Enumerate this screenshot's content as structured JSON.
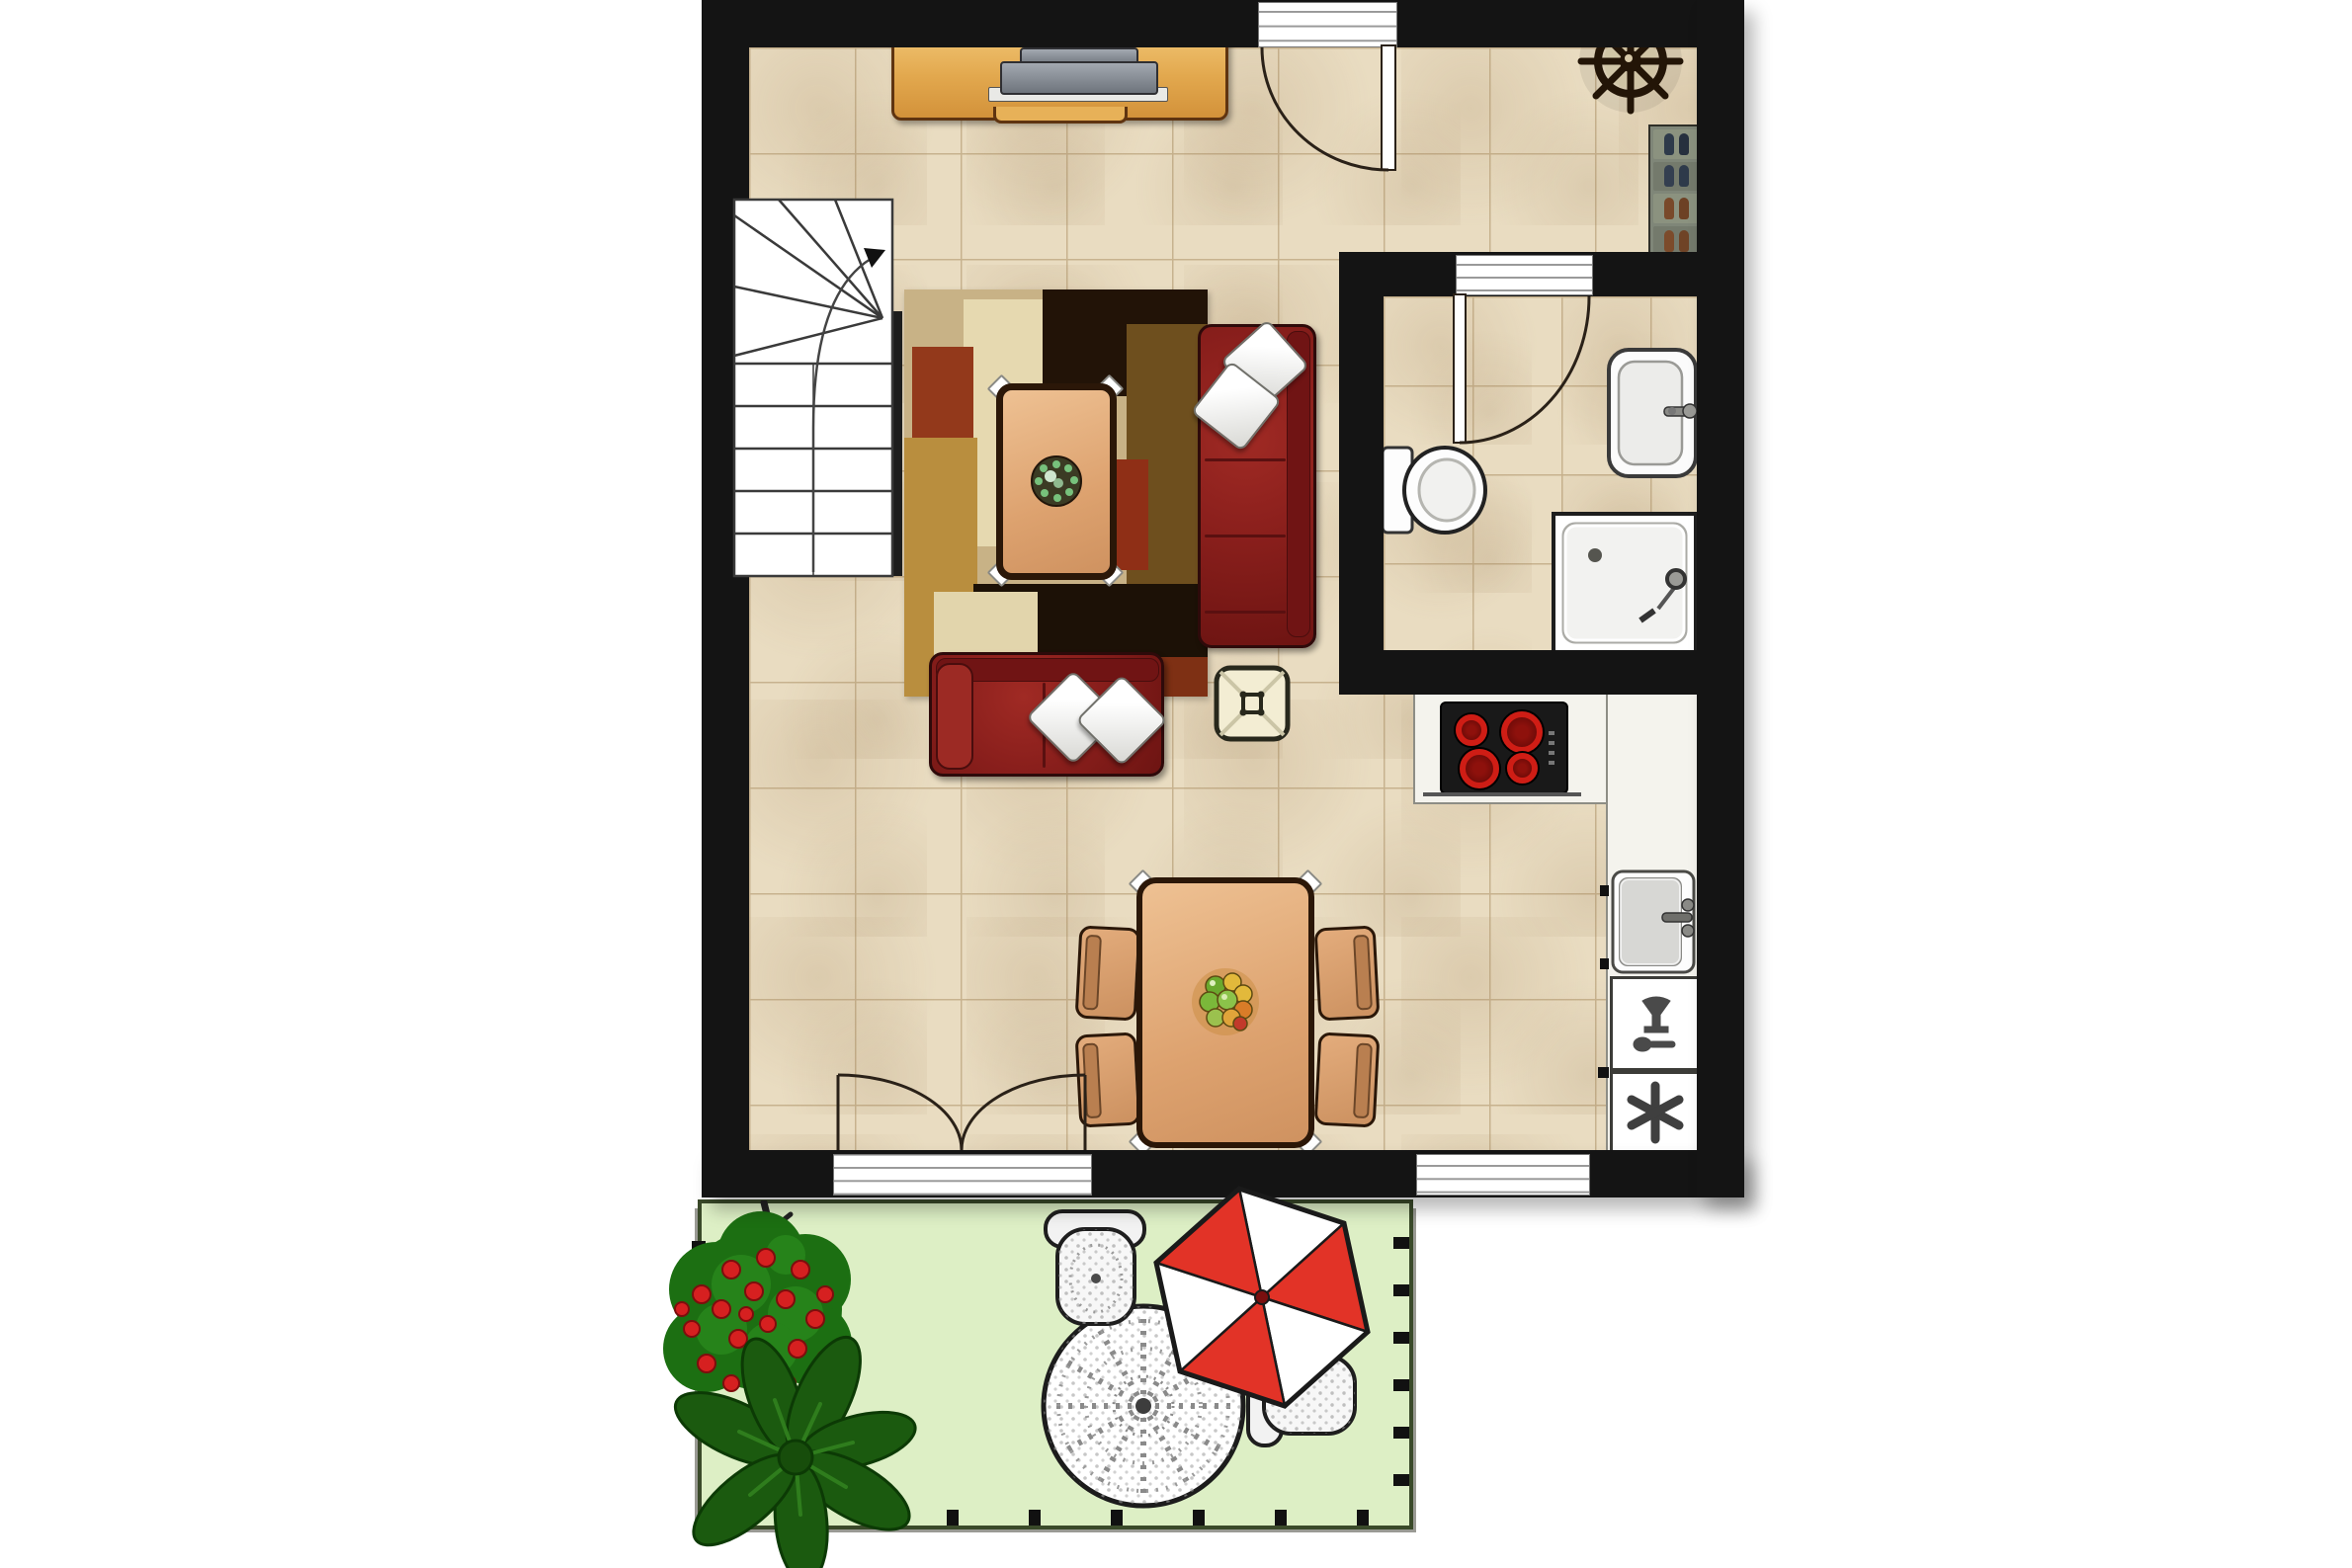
{
  "document": {
    "kind": "architectural-floor-plan",
    "view": "top-down",
    "level": "ground-floor-with-terrace"
  },
  "colors": {
    "background": "#ffffff",
    "wall": "#141414",
    "floor_tile": "#e9dcc1",
    "floor_tile_line": "#c7b28e",
    "counter": "#f4f3ed",
    "counter_edge": "#8d8d85",
    "sofa_red": "#8a1f1c",
    "sofa_outline": "#2e0a0a",
    "pillow": "#f2f2ef",
    "wood_light": "#e2aa79",
    "wood_dark": "#2b1708",
    "sideboard": "#e9b55c",
    "rug_base": "#c8b286",
    "lawn": "#ddefc5",
    "garden_border": "#3a4a2a",
    "bush_green": "#1c6f12",
    "flower_red": "#d62020",
    "umbrella_red": "#e23327",
    "umbrella_white": "#ffffff",
    "stove_black": "#191919",
    "burner_red": "#cf1d15",
    "fixture_white": "#fbfbfb",
    "fixture_outline": "#333333",
    "stair_white": "#ffffff",
    "lace_white": "#f7f7f7"
  },
  "rooms": {
    "living": {
      "label": "living-area"
    },
    "dining": {
      "label": "dining-area"
    },
    "kitchen": {
      "label": "kitchen-corner"
    },
    "bathroom": {
      "label": "bathroom"
    },
    "stairs": {
      "label": "staircase"
    },
    "garden": {
      "label": "terrace-garden"
    }
  },
  "inventory": {
    "doors": {
      "entry_door": 1,
      "bathroom_door": 1,
      "french_doors": 1,
      "windows": 1
    },
    "staircase": {
      "straight_treads": 6,
      "winder_treads": 5,
      "direction_arrow": "up"
    },
    "living": {
      "sofas": 2,
      "throw_pillows": 4,
      "coffee_table": 1,
      "ottoman": 1,
      "area_rug": 1,
      "tv_sideboard": 1,
      "ships_wheel_decor": 1,
      "shoe_rack_shelves": 5,
      "shoe_pairs": 5
    },
    "dining": {
      "table": 1,
      "chairs": 4,
      "fruit_bowl": 1
    },
    "kitchen": {
      "cooktop_burners": 4,
      "sink": 1,
      "dishwasher": 1,
      "freezer": 1
    },
    "bathroom": {
      "toilet": 1,
      "washbasin": 1,
      "shower": 1
    },
    "garden": {
      "parasol_panels": 6,
      "lace_table": 1,
      "lace_chairs": 2,
      "flowering_bush": 1,
      "large_plant": 1,
      "fence_ticks_bottom": 6,
      "fence_ticks_right": 6
    }
  }
}
